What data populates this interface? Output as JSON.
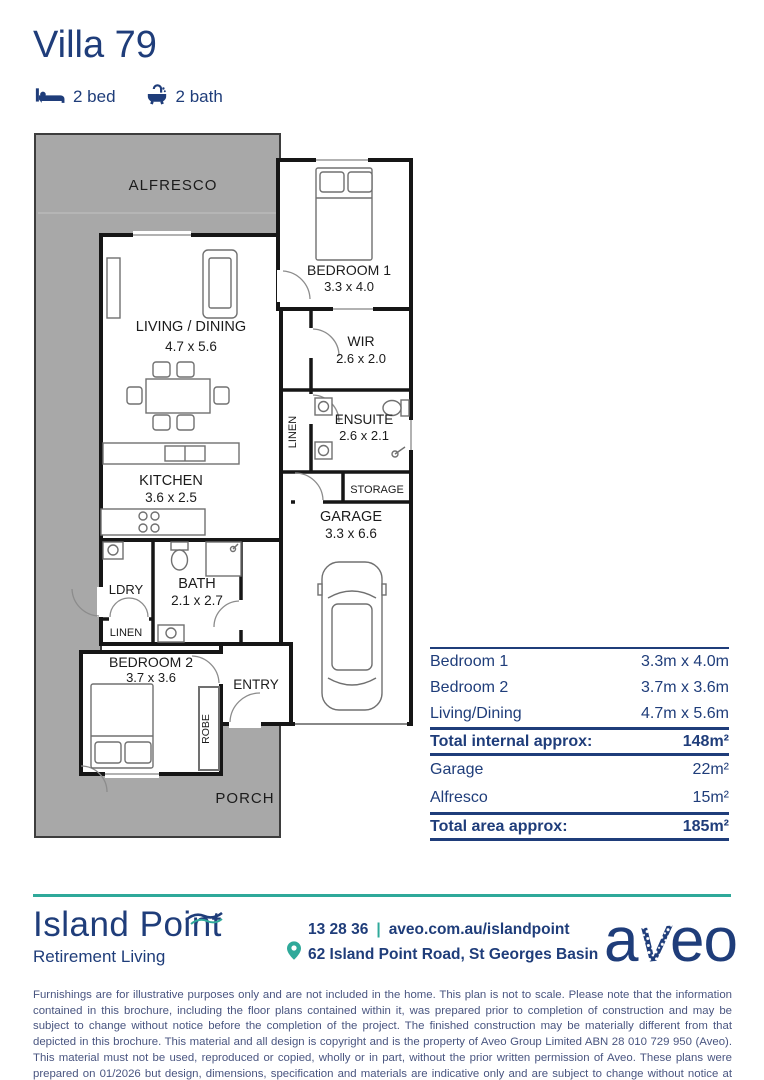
{
  "colors": {
    "navy": "#1f3d7a",
    "teal": "#2fa99a",
    "plan_gray": "#a8a8a8",
    "wall": "#161616"
  },
  "header": {
    "title": "Villa 79",
    "bed_label": "2 bed",
    "bath_label": "2 bath"
  },
  "floorplan": {
    "alfresco": {
      "name": "ALFRESCO"
    },
    "bedroom1": {
      "name": "BEDROOM 1",
      "dims": "3.3 x 4.0"
    },
    "living": {
      "name": "LIVING / DINING",
      "dims": "4.7 x 5.6"
    },
    "wir": {
      "name": "WIR",
      "dims": "2.6 x 2.0"
    },
    "ensuite": {
      "name": "ENSUITE",
      "dims": "2.6 x 2.1"
    },
    "linen_hall": {
      "name": "LINEN"
    },
    "storage": {
      "name": "STORAGE"
    },
    "garage": {
      "name": "GARAGE",
      "dims": "3.3 x 6.6"
    },
    "kitchen": {
      "name": "KITCHEN",
      "dims": "3.6 x 2.5"
    },
    "laundry": {
      "name": "LDRY"
    },
    "bath": {
      "name": "BATH",
      "dims": "2.1 x 2.7"
    },
    "linen2": {
      "name": "LINEN"
    },
    "bedroom2": {
      "name": "BEDROOM 2",
      "dims": "3.7 x 3.6"
    },
    "entry": {
      "name": "ENTRY"
    },
    "robe": {
      "name": "ROBE"
    },
    "porch": {
      "name": "PORCH"
    }
  },
  "table": {
    "rows": [
      {
        "label": "Bedroom 1",
        "value": "3.3m x 4.0m"
      },
      {
        "label": "Bedroom 2",
        "value": "3.7m x 3.6m"
      },
      {
        "label": "Living/Dining",
        "value": "4.7m x 5.6m"
      }
    ],
    "total_internal": {
      "label": "Total internal approx:",
      "value": "148m²"
    },
    "areas": [
      {
        "label": "Garage",
        "value": "22m²"
      },
      {
        "label": "Alfresco",
        "value": "15m²"
      }
    ],
    "total_area": {
      "label": "Total area approx:",
      "value": "185m²"
    }
  },
  "footer": {
    "brand": {
      "name": "Island Point",
      "tagline": "Retirement Living"
    },
    "contact": {
      "phone": "13 28 36",
      "separator": "|",
      "website": "aveo.com.au/islandpoint",
      "address": "62 Island Point Road, St Georges Basin"
    },
    "logo": {
      "a": "a",
      "v": "v",
      "eo": "eo",
      "full": "aveo"
    }
  },
  "disclaimer": "Furnishings are for illustrative purposes only and are not included in the home. This plan is not to scale. Please note that the information contained in this brochure, including the floor plans contained within it, was prepared prior to completion of construction and may be subject to change without notice before the completion of the project. The finished construction may be materially different from that depicted in this brochure. This material and all design is copyright and is the property of Aveo Group Limited ABN 28 010 729 950 (Aveo). This material must not be used, reproduced or copied, wholly or in part, without the prior written permission of Aveo. These plans were prepared on 01/2026 but design, dimensions, specification and materials are indicative only and are subject to change without notice at anytime and intending purchasers should undertake their own independent inquiries to satisfy themselves regarding the status of these plans. You should refer to appropriate Survey Plans for confirmation of individual unit areas."
}
